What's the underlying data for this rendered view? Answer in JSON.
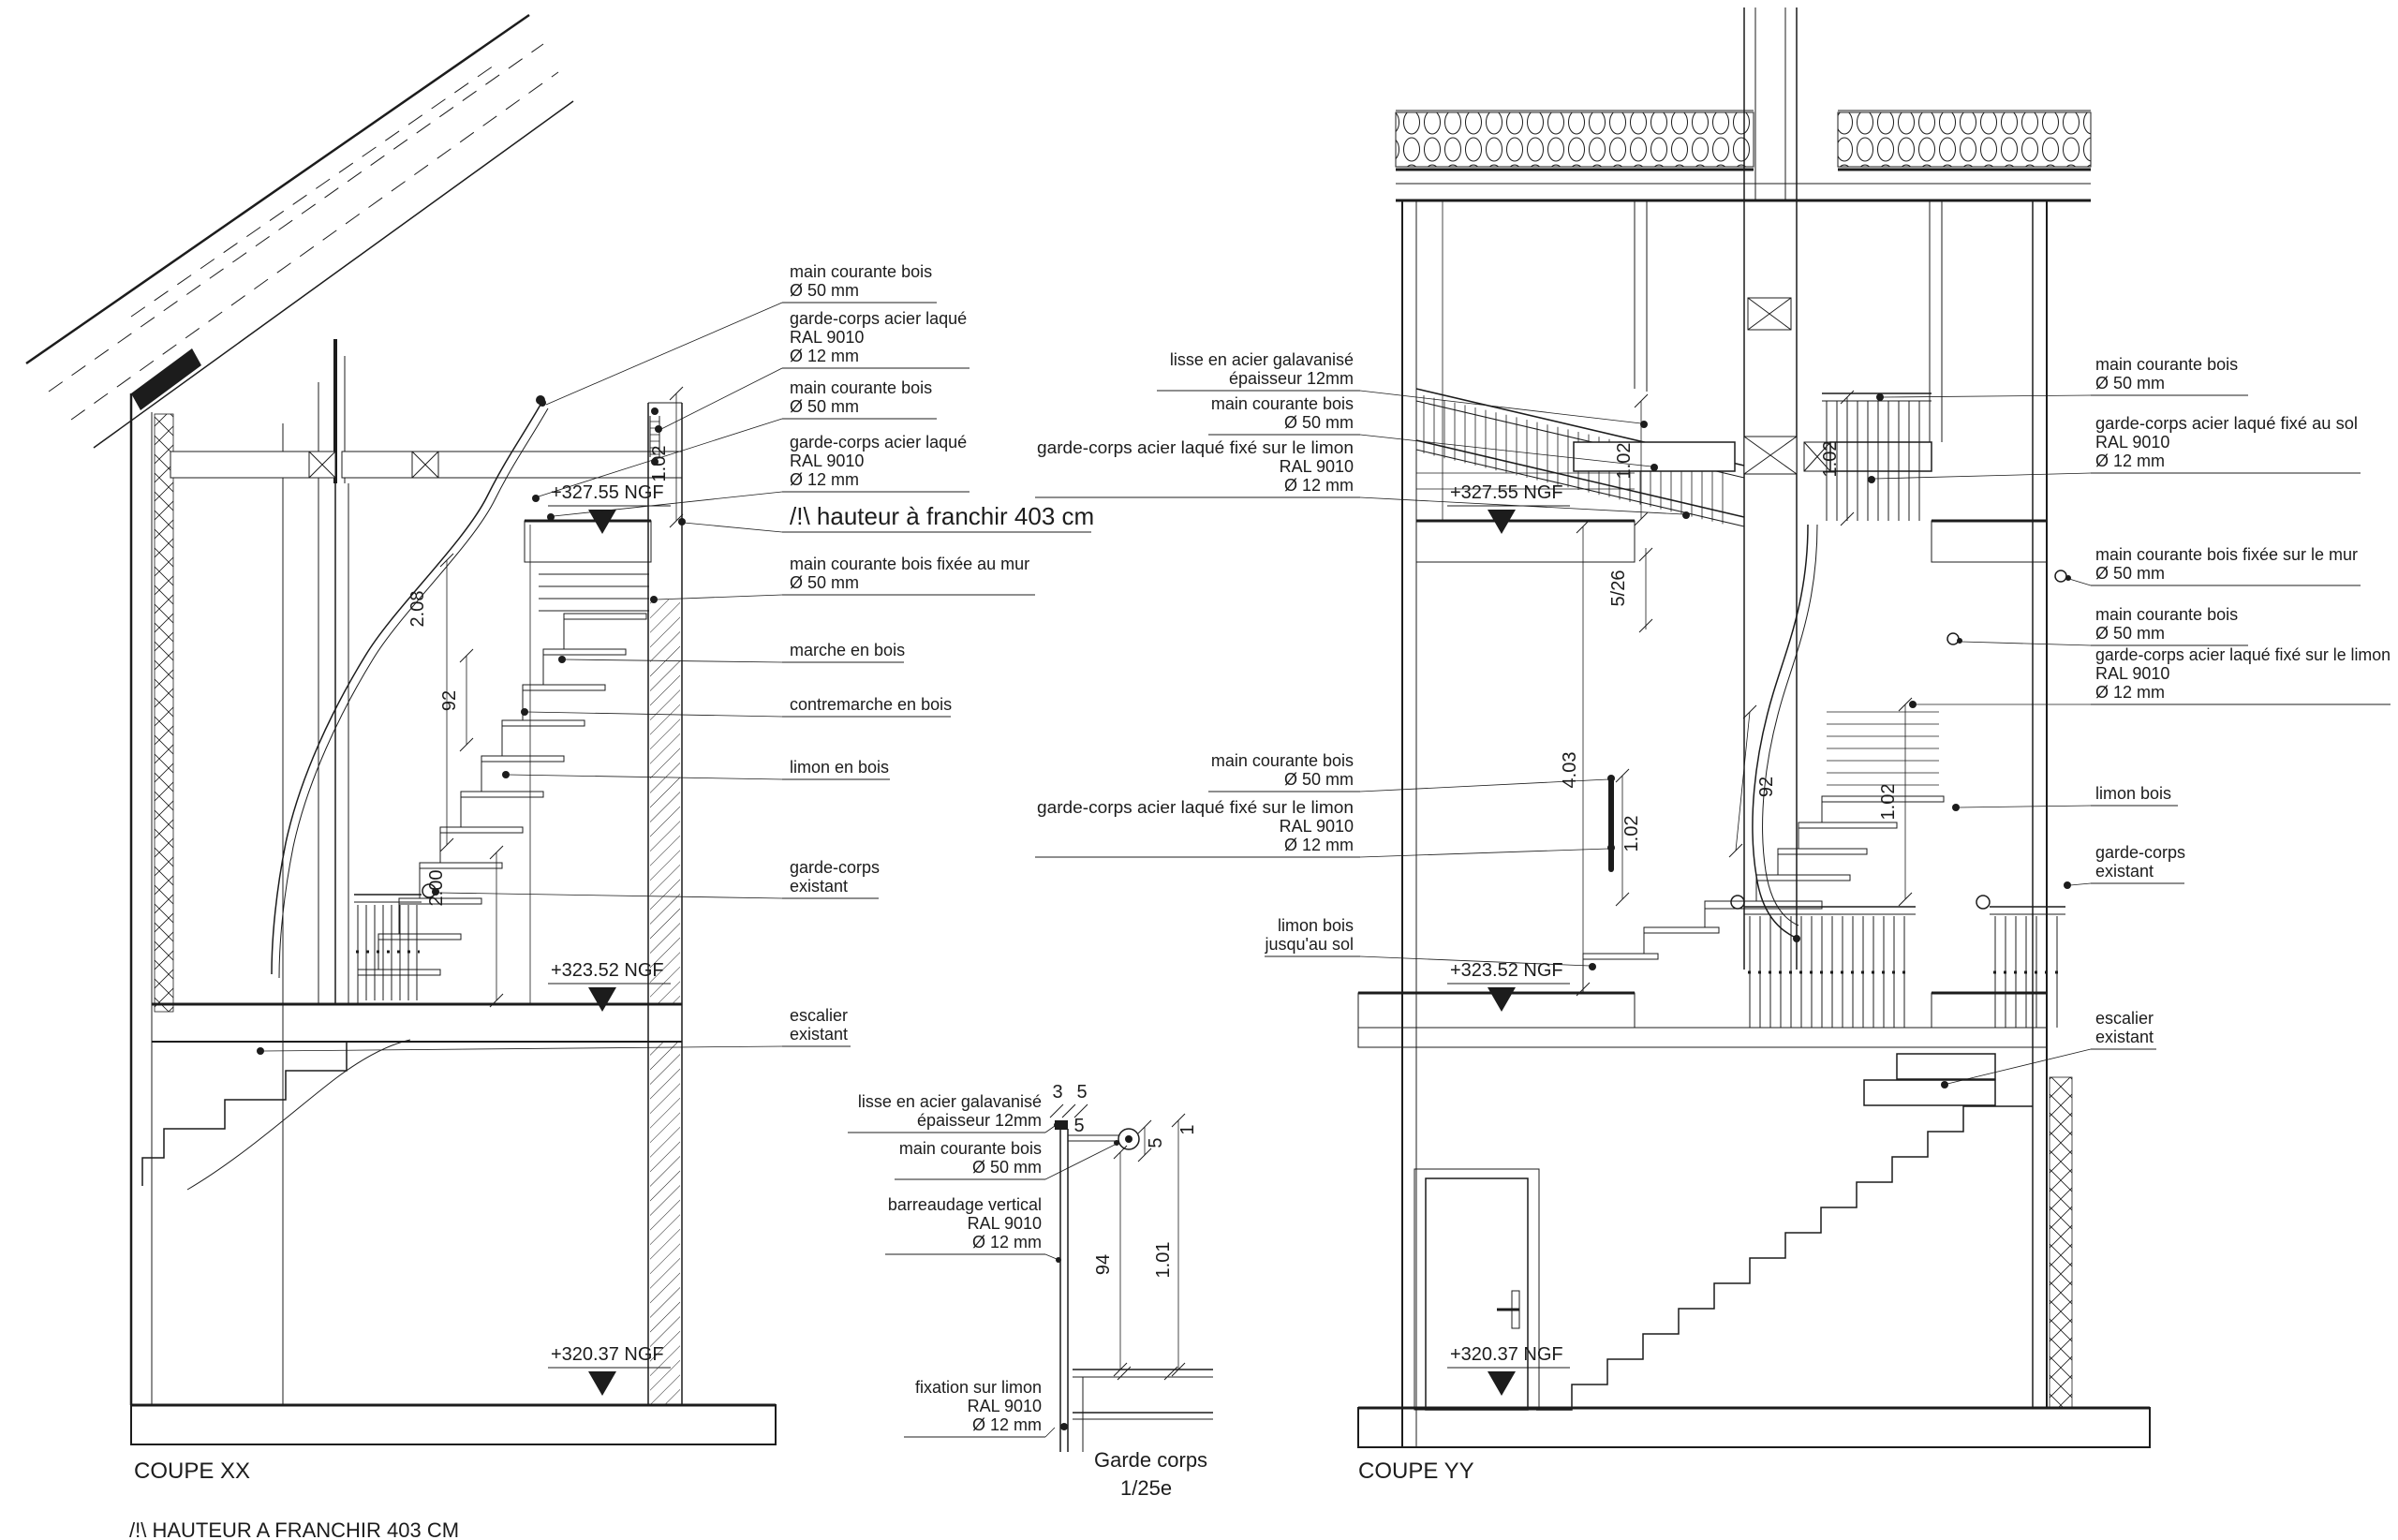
{
  "sheet": {
    "background": "#ffffff",
    "ink": "#1c1c1c"
  },
  "coupe_xx": {
    "title": "COUPE XX",
    "footnote": "/!\\ HAUTEUR A FRANCHIR 403 CM",
    "levels": [
      {
        "label": "+327.55 NGF"
      },
      {
        "label": "+323.52 NGF"
      },
      {
        "label": "+320.37 NGF"
      }
    ],
    "dims": {
      "rail_top": "1.02",
      "flight": "2.08",
      "rail_mid": "92",
      "rail_low": "2.00"
    },
    "labels": [
      {
        "lines": [
          "main courante bois",
          "Ø 50 mm"
        ]
      },
      {
        "lines": [
          "garde-corps acier laqué",
          "RAL 9010",
          "Ø 12 mm"
        ]
      },
      {
        "lines": [
          "main courante bois",
          "Ø 50 mm"
        ]
      },
      {
        "lines": [
          "garde-corps acier laqué",
          "RAL 9010",
          "Ø 12 mm"
        ]
      },
      {
        "lines": [
          "/!\\ hauteur à franchir 403 cm"
        ]
      },
      {
        "lines": [
          "main courante bois fixée au mur",
          "Ø 50 mm"
        ]
      },
      {
        "lines": [
          "marche en bois"
        ]
      },
      {
        "lines": [
          "contremarche en bois"
        ]
      },
      {
        "lines": [
          "limon en bois"
        ]
      },
      {
        "lines": [
          "garde-corps",
          "existant"
        ]
      },
      {
        "lines": [
          "escalier",
          "existant"
        ]
      }
    ]
  },
  "detail": {
    "title": "Garde corps",
    "scale": "1/25e",
    "dims": {
      "top_left": "3",
      "top_mid": "5",
      "post": "5",
      "rail": "5",
      "top_right": "1",
      "bars": "94",
      "total": "1.01"
    },
    "labels": [
      {
        "lines": [
          "lisse en acier galavanisé",
          "épaisseur 12mm"
        ]
      },
      {
        "lines": [
          "main courante bois",
          "Ø 50 mm"
        ]
      },
      {
        "lines": [
          "barreaudage vertical",
          "RAL 9010",
          "Ø 12 mm"
        ]
      },
      {
        "lines": [
          "fixation sur limon",
          "RAL 9010",
          "Ø 12 mm"
        ]
      }
    ]
  },
  "coupe_yy": {
    "title": "COUPE YY",
    "levels": [
      {
        "label": "+327.55 NGF"
      },
      {
        "label": "+323.52 NGF"
      },
      {
        "label": "+320.37 NGF"
      }
    ],
    "dims": {
      "rail_upper": "1.02",
      "slope": "5/26",
      "rail_beam": "1.02",
      "total": "4.03",
      "rail_post": "1.02",
      "winder": "92",
      "rail_right": "1.02"
    },
    "labels_left": [
      {
        "lines": [
          "lisse en acier galavanisé",
          "épaisseur 12mm"
        ]
      },
      {
        "lines": [
          "main courante bois",
          "Ø 50 mm"
        ]
      },
      {
        "lines": [
          "garde-corps acier laqué fixé sur le limon",
          "RAL 9010",
          "Ø 12 mm"
        ]
      },
      {
        "lines": [
          "main courante bois",
          "Ø 50 mm"
        ]
      },
      {
        "lines": [
          "garde-corps acier laqué fixé sur le limon",
          "RAL 9010",
          "Ø 12 mm"
        ]
      },
      {
        "lines": [
          "limon bois",
          "jusqu'au sol"
        ]
      }
    ],
    "labels_right": [
      {
        "lines": [
          "main courante bois",
          "Ø 50 mm"
        ]
      },
      {
        "lines": [
          "garde-corps acier laqué fixé au sol",
          "RAL 9010",
          "Ø 12 mm"
        ]
      },
      {
        "lines": [
          "main courante bois fixée sur le mur",
          "Ø 50 mm"
        ]
      },
      {
        "lines": [
          "main courante bois",
          "Ø 50 mm"
        ]
      },
      {
        "lines": [
          "garde-corps acier laqué fixé sur le limon",
          "RAL 9010",
          "Ø 12 mm"
        ]
      },
      {
        "lines": [
          "limon bois"
        ]
      },
      {
        "lines": [
          "garde-corps",
          "existant"
        ]
      },
      {
        "lines": [
          "escalier",
          "existant"
        ]
      }
    ]
  }
}
